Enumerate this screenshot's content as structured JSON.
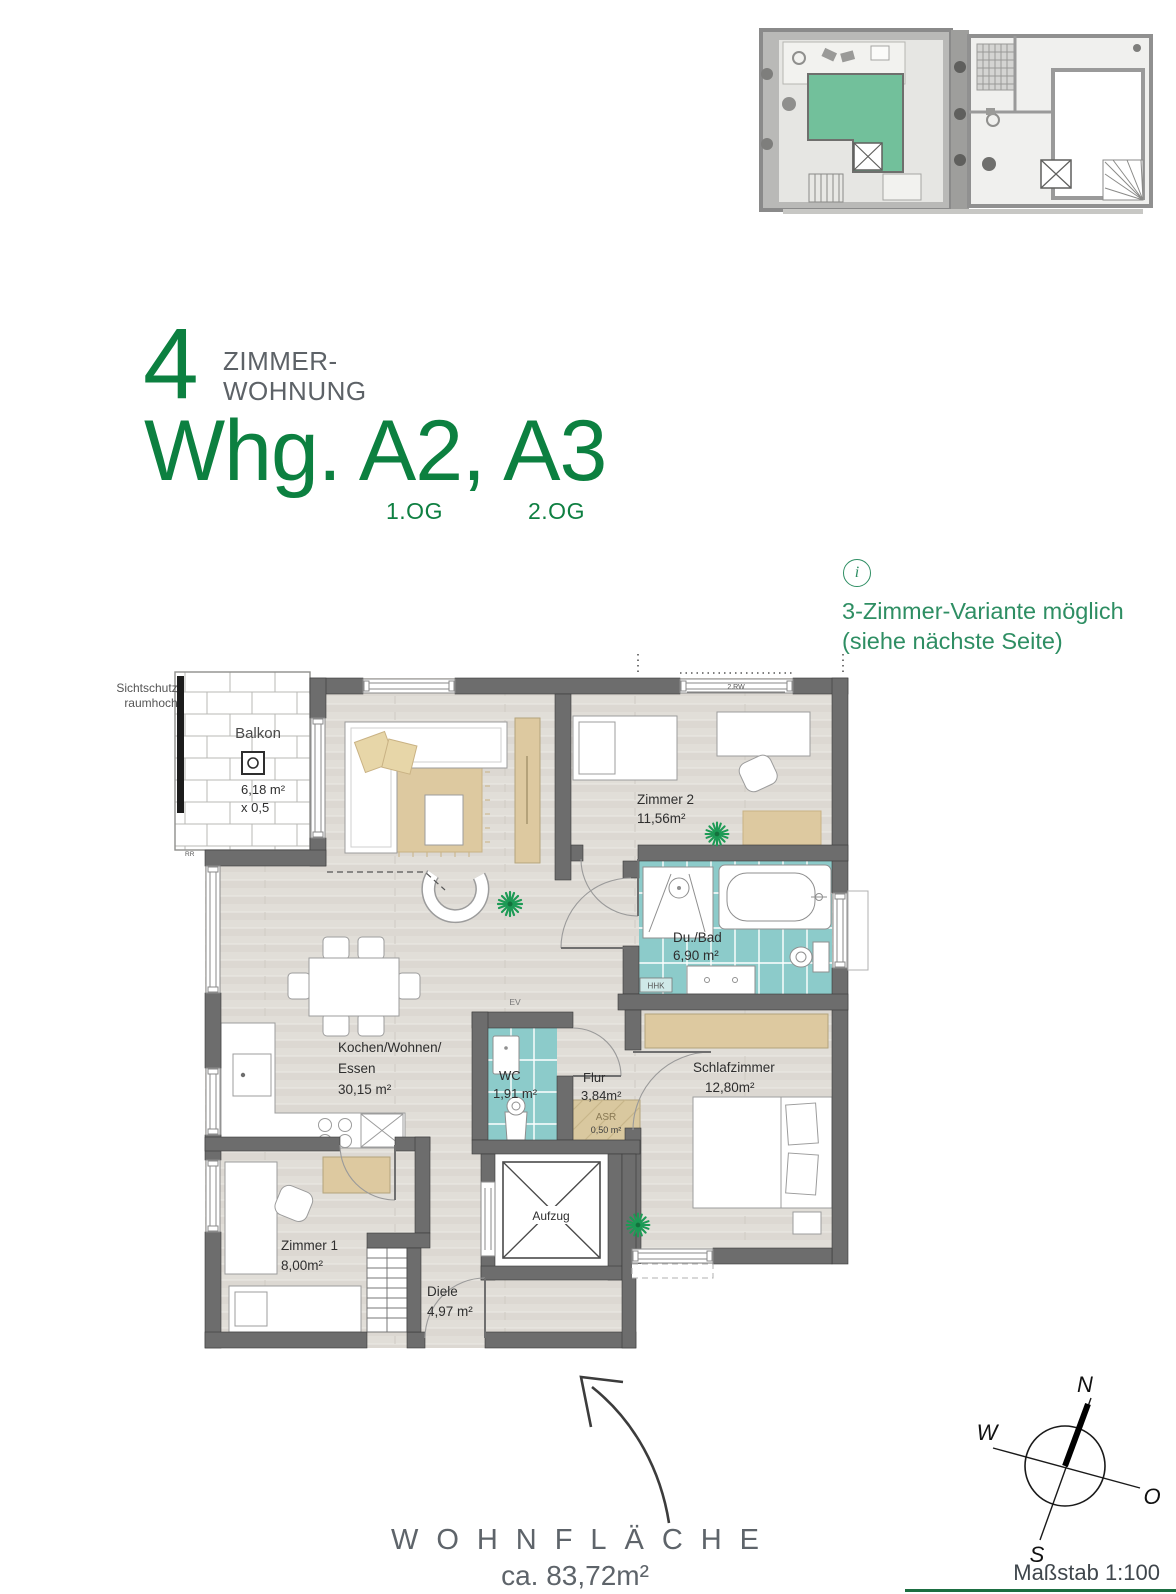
{
  "title": {
    "number": "4",
    "type_line1": "ZIMMER-",
    "type_line2": "WOHNUNG",
    "name": "Whg. A2, A3",
    "floor_left": "1.OG",
    "floor_right": "2.OG"
  },
  "info": {
    "icon": "i",
    "line1": "3-Zimmer-Variante möglich",
    "line2": "(siehe nächste Seite)"
  },
  "plan": {
    "sichtschutz_line1": "Sichtschutz",
    "sichtschutz_line2": "raumhoch",
    "balkon": {
      "name": "Balkon",
      "area": "6,18 m²",
      "factor": "x 0,5"
    },
    "rr": "RR",
    "rw": "2.RW",
    "zimmer2": {
      "name": "Zimmer 2",
      "area": "11,56m²"
    },
    "bad": {
      "name": "Du./Bad",
      "area": "6,90 m²",
      "hhk": "HHK"
    },
    "wohnen": {
      "line1": "Kochen/Wohnen/",
      "line2": "Essen",
      "area": "30,15 m²"
    },
    "wc": {
      "name": "WC",
      "area": "1,91 m²"
    },
    "flur": {
      "name": "Flur",
      "area": "3,84m²"
    },
    "asr": {
      "name": "ASR",
      "area": "0,50 m²"
    },
    "schlafzimmer": {
      "name": "Schlafzimmer",
      "area": "12,80m²"
    },
    "zimmer1": {
      "name": "Zimmer 1",
      "area": "8,00m²"
    },
    "diele": {
      "name": "Diele",
      "area": "4,97 m²"
    },
    "aufzug": "Aufzug",
    "ev": "EV"
  },
  "footer": {
    "label": "WOHNFLÄCHE",
    "area": "ca. 83,72m²",
    "scale": "Maßstab 1:100"
  },
  "compass": {
    "n": "N",
    "o": "O",
    "s": "S",
    "w": "W"
  },
  "colors": {
    "brand_green": "#0c8040",
    "info_green": "#2e8e63",
    "wall_gray": "#6d6d6d",
    "tile_teal": "#8ccbca",
    "furniture_tan": "#ddc9a0",
    "floor_gray": "#e1ded9",
    "footer_gray": "#5e646a",
    "accent_line_green": "#1d6f42",
    "siteplan_green": "#72c09b"
  }
}
